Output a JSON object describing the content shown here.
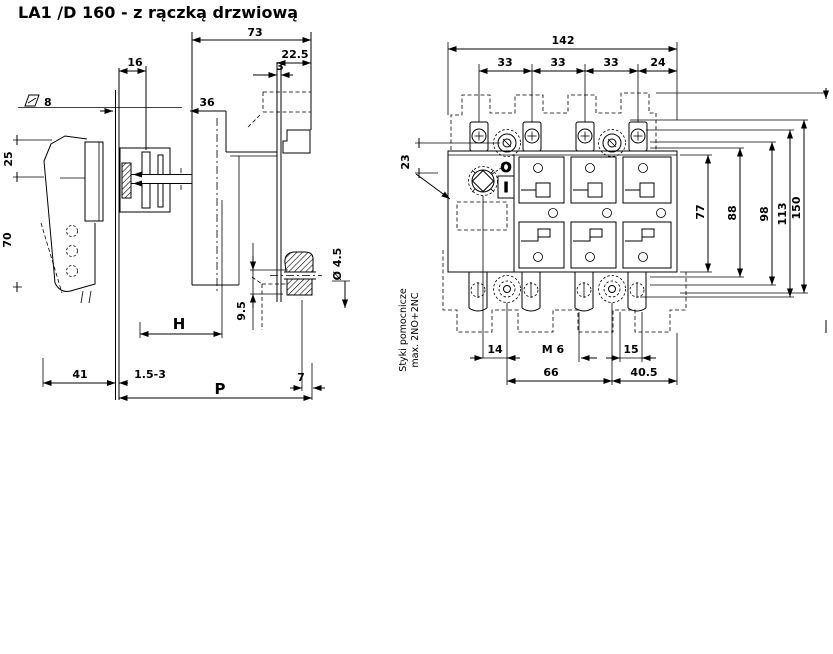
{
  "title": "LA1 /D 160 - z rączką drzwiową",
  "colors": {
    "ink": "#000000",
    "paper": "#ffffff"
  },
  "side_view": {
    "dims": {
      "depth_total": "73",
      "panel_to_boss": "22.5",
      "panel_thickness": "3",
      "shaft_square": "8",
      "front_width": "16",
      "front_depth": "36",
      "handle_offset": "25",
      "handle_length": "70",
      "handle_depth": "41",
      "door_thickness_range": "1.5-3",
      "shaft_length_var": "H",
      "depth_var": "P",
      "boss_depth": "9.5",
      "boss_offset": "7",
      "hole_dia": "Ø 4.5"
    }
  },
  "front_view": {
    "dims": {
      "width_total": "142",
      "pole_pitch_1": "33",
      "pole_pitch_2": "33",
      "pole_pitch_3": "33",
      "edge_offset": "24",
      "handle_top_offset": "23",
      "height_body": "77",
      "height_1": "88",
      "height_2": "98",
      "height_3": "113",
      "height_total": "150",
      "fix_offset_left": "14",
      "fix_thread": "M 6",
      "fix_offset_right": "15",
      "fix_spacing": "66",
      "fix_to_edge": "40.5"
    },
    "switch_positions": {
      "off": "O",
      "on": "I"
    },
    "note_line1": "Styki pomocnicze",
    "note_line2": "max. 2NO+2NC"
  }
}
